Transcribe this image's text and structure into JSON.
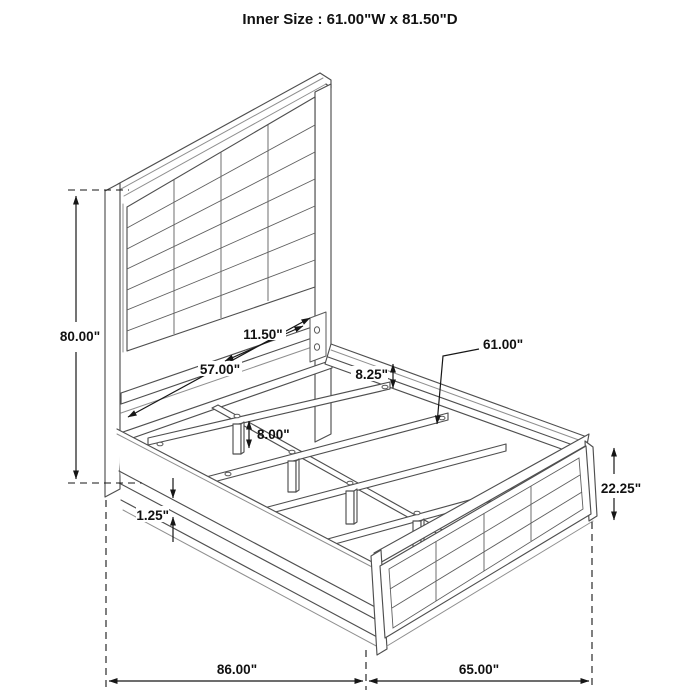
{
  "title": "Inner Size : 61.00\"W x 81.50\"D",
  "dimensions": {
    "overall_height": "80.00\"",
    "headboard_inner_width": "57.00\"",
    "headboard_bottom_gap": "11.50\"",
    "rail_top_to_slat": "8.25\"",
    "slat_length": "61.00\"",
    "leg_height": "8.00\"",
    "rail_lip": "1.25\"",
    "footboard_height": "22.25\"",
    "overall_length": "86.00\"",
    "overall_width": "65.00\""
  },
  "colors": {
    "background": "#ffffff",
    "structure_line": "#4f4f4f",
    "dimension_line": "#161616",
    "text": "#111111"
  }
}
